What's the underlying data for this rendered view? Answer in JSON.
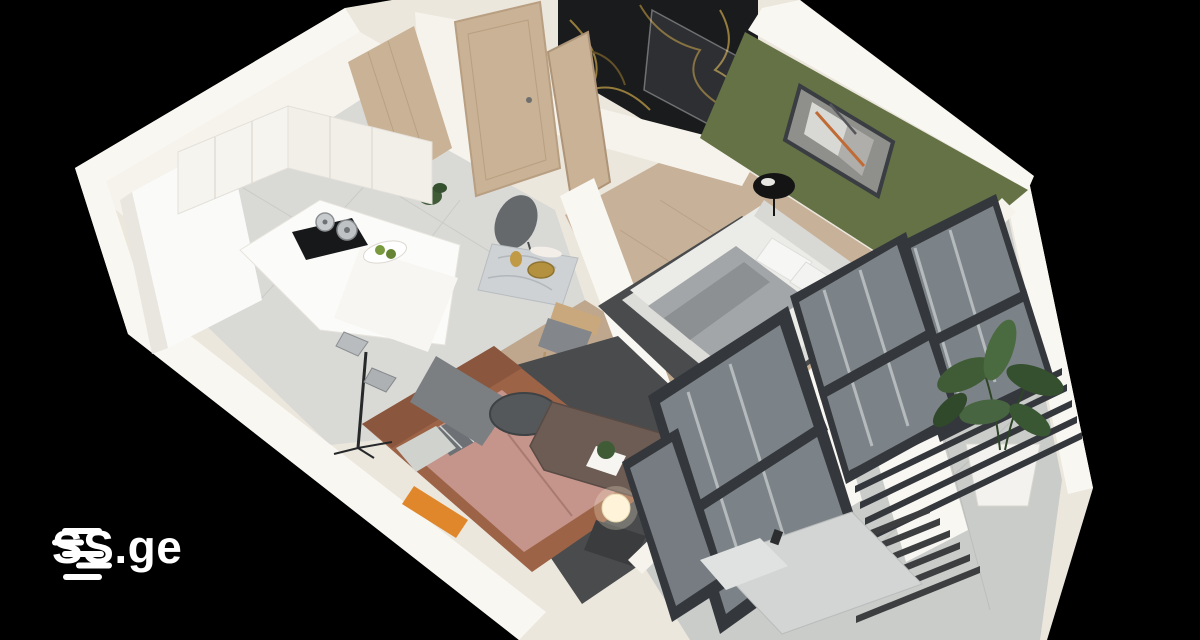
{
  "logo": {
    "text": "SS.ge",
    "icon": "ss-lines-logo-icon"
  },
  "palette": {
    "background": "#000000",
    "wall_cream": "#ece7dd",
    "wall_bright": "#f9f7f2",
    "wall_white": "#f6f3ed",
    "tile_floor": "#d9d9d6",
    "wood_floor": "#c8b199",
    "wood_floor_dark": "#bfa78e",
    "balcony_floor": "#caccca",
    "green_wall": "#657246",
    "marble_black": "#1a1b1d",
    "marble_gold": "#aa8d42",
    "wood_door": "#c9b295",
    "frame_dark": "#34373c",
    "rug_dark": "#494b4d",
    "sofa_leather": "#9c6347",
    "sofa_cushion": "#c5948a",
    "accent_orange": "#e0872b",
    "bed_white": "#ebebe8",
    "throw_gray": "#a3a6a8",
    "plant_green": "#3f5c37",
    "glass_tint": "#b8c2c7",
    "lamp_glow": "#fff3d9",
    "logo_white": "#ffffff"
  }
}
